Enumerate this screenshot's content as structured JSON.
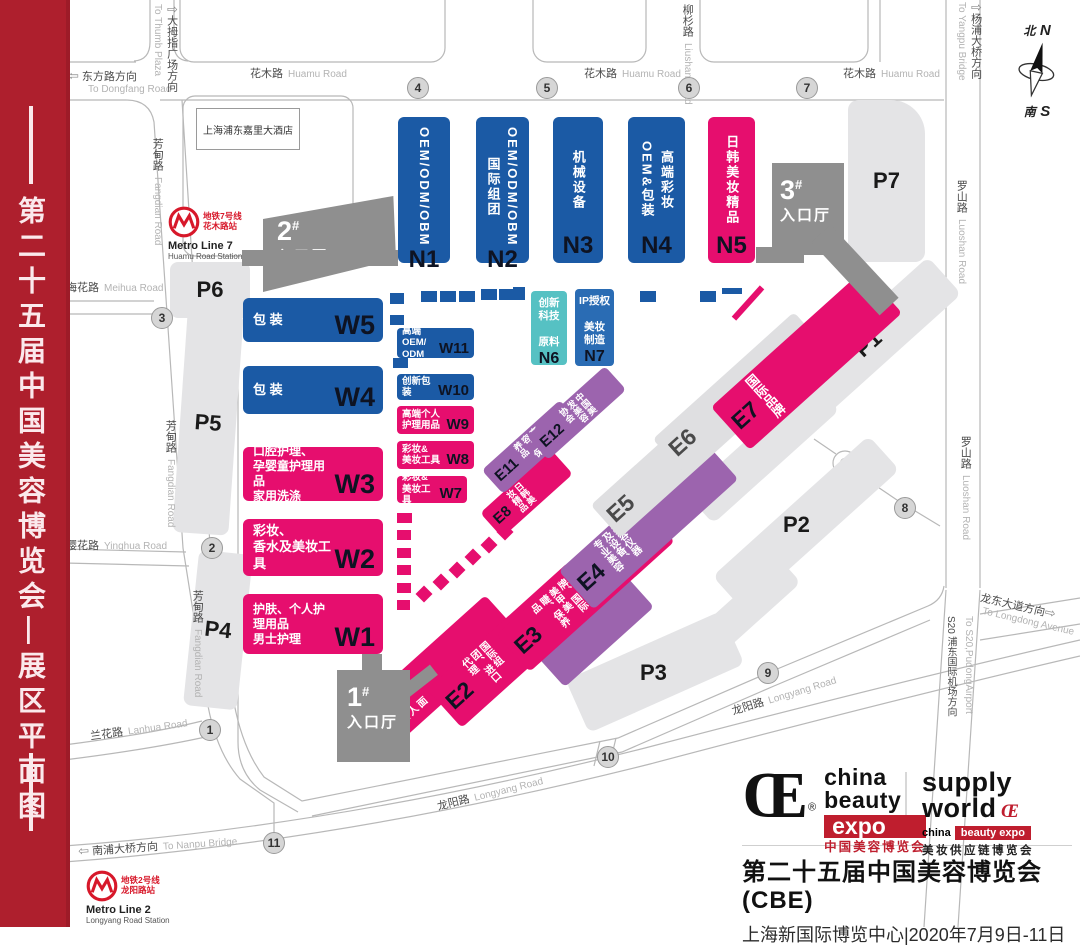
{
  "banner": {
    "title": "第二十五届中国美容博览会—展区平面图"
  },
  "compass": {
    "n_cn": "北",
    "n_en": "N",
    "s_cn": "南",
    "s_en": "S"
  },
  "roads": {
    "huamu_cn": "花木路",
    "huamu_en": "Huamu Road",
    "fangdian_cn": "芳甸路",
    "fangdian_en": "Fangdian Road",
    "meihua_cn": "梅花路",
    "meihua_en": "Meihua Road",
    "yinghua_cn": "樱花路",
    "yinghua_en": "Yinghua Road",
    "lanhua_cn": "兰花路",
    "lanhua_en": "Lanhua Road",
    "longyang_cn": "龙阳路",
    "longyang_en": "Longyang Road",
    "luoshan_cn": "罗山路",
    "luoshan_en": "Luoshan Road",
    "liushan_cn": "柳杉路",
    "liushan_en": "Liushan Road",
    "dongfang_arrow": "⇦",
    "dongfang_cn": "东方路方向",
    "dongfang_en": "To Dongfang Road",
    "thumb_arrow": "⇧",
    "thumb_cn": "大拇指广场方向",
    "thumb_en": "To Thumb Plaza",
    "yangpu_arrow": "⇧",
    "yangpu_cn": "杨浦大桥方向",
    "yangpu_en": "To Yangpu Bridge",
    "nanpu_arrow": "⇦",
    "nanpu_cn": "南浦大桥方向",
    "nanpu_en": "To Nanpu Bridge",
    "longdong_arrow": "⇨",
    "longdong_cn": "龙东大道方向",
    "longdong_en": "To Longdong Avenue",
    "s20_cn": "S20 浦东国际机场方向",
    "s20_en": "To S20,PudongAirport"
  },
  "gates": {
    "g1": "1",
    "g2": "2",
    "g3": "3",
    "g4": "4",
    "g5": "5",
    "g6": "6",
    "g7": "7",
    "g8": "8",
    "g9": "9",
    "g10": "10",
    "g11": "11"
  },
  "hotel": "上海浦东嘉里大酒店",
  "metro7": {
    "cn1": "地铁7号线",
    "cn2": "花木路站",
    "en1": "Metro Line 7",
    "en2": "Huamu Road Station"
  },
  "metro2": {
    "cn1": "地铁2号线",
    "cn2": "龙阳路站",
    "en1": "Metro Line 2",
    "en2": "Longyang Road Station"
  },
  "entrances": {
    "h1": {
      "num": "1",
      "mark": "#",
      "label": "入口厅"
    },
    "h2": {
      "num": "2",
      "mark": "#",
      "label": "入口厅"
    },
    "h3": {
      "num": "3",
      "mark": "#",
      "label": "入口厅"
    }
  },
  "parking": {
    "p1": "P1",
    "p2": "P2",
    "p3": "P3",
    "p4": "P4",
    "p5": "P5",
    "p6": "P6",
    "p7": "P7"
  },
  "halls": {
    "n1": {
      "code": "N1",
      "l1": "OEM/ODM/OBM",
      "l2": ""
    },
    "n2": {
      "code": "N2",
      "l1": "OEM/ODM/OBM",
      "l2": "国际组团"
    },
    "n3": {
      "code": "N3",
      "l1": "机械设备",
      "l2": ""
    },
    "n4": {
      "code": "N4",
      "l1": "高端彩妆OEM&",
      "l2": "包装"
    },
    "n5": {
      "code": "N5",
      "l1": "日韩美妆精品",
      "l2": ""
    },
    "n6": {
      "code": "N6",
      "label": "创新\n科技\n\n原料"
    },
    "n7": {
      "code": "N7",
      "label": "IP授权\n\n美妆\n制造"
    },
    "w1": {
      "code": "W1",
      "label": "护肤、个人护理用品\n男士护理"
    },
    "w2": {
      "code": "W2",
      "label": "彩妆、\n香水及美妆工具"
    },
    "w3": {
      "code": "W3",
      "label": "口腔护理、\n孕婴童护理用品\n家用洗涤"
    },
    "w4": {
      "code": "W4",
      "label": "包 装"
    },
    "w5": {
      "code": "W5",
      "label": "包 装"
    },
    "w7": {
      "code": "W7",
      "label": "彩妆&\n美妆工具"
    },
    "w8": {
      "code": "W8",
      "label": "彩妆&\n美妆工具"
    },
    "w9": {
      "code": "W9",
      "label": "高端个人\n护理用品"
    },
    "w10": {
      "code": "W10",
      "label": "创新包装"
    },
    "w11": {
      "code": "W11",
      "label": "高端OEM/\nODM"
    },
    "e1": {
      "code": "E1",
      "label": "护肤、面膜、个人护理用品"
    },
    "e2": {
      "code": "E2",
      "label": "国际组团、进口代理"
    },
    "e3": {
      "code": "E3",
      "label": "国际品牌、国际美甲美睫、保养品"
    },
    "e4": {
      "code": "E4",
      "label": "美容仪器及设备、专业美容"
    },
    "e5": {
      "code": "E5"
    },
    "e6": {
      "code": "E6"
    },
    "e7": {
      "code": "E7",
      "label": "国际品牌"
    },
    "e8": {
      "code": "E8",
      "label": "日韩美妆精品"
    },
    "e11": {
      "code": "E11",
      "label": "高端美容、保养品"
    },
    "e12": {
      "code": "E12",
      "label": "中国美发美容协会"
    }
  },
  "footer": {
    "cbe": {
      "mark": "Œ",
      "reg": "®",
      "w1": "china",
      "w2": "beauty",
      "w3": "expo",
      "cn": "中国美容博览会"
    },
    "sw": {
      "w1": "supply",
      "w2": "world",
      "mark": "Œ",
      "b1": "china",
      "b2": "beauty expo",
      "cn": "美妆供应链博览会"
    },
    "title": "第二十五届中国美容博览会(CBE)",
    "subtitle": "上海新国际博览中心|2020年7月9日-11日"
  }
}
